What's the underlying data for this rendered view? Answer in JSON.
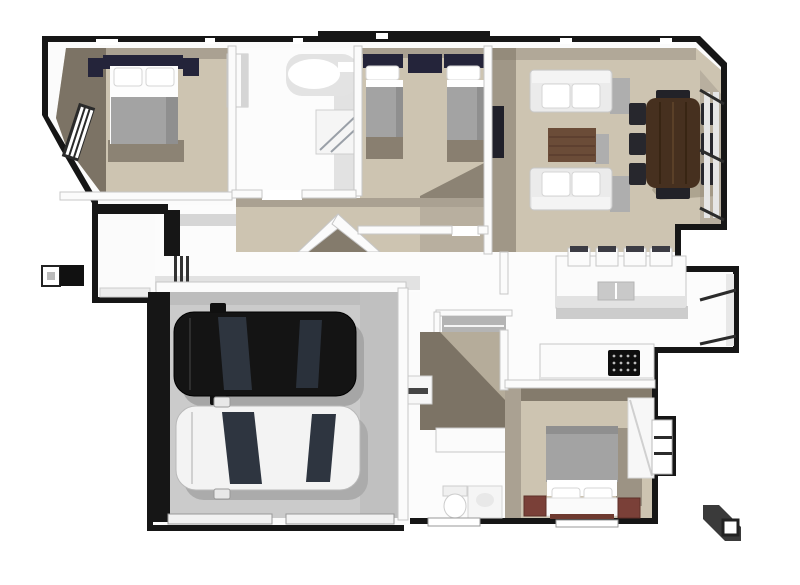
{
  "scene": {
    "type": "3d-floor-plan-render-top-view",
    "background": "#ffffff"
  },
  "colors": {
    "background": "#ffffff",
    "outline": "#161616",
    "wall": "#fbfbfb",
    "wall_edge": "#c7c7c7",
    "carpet": "#cdc4b1",
    "carpet_mid": "#aaa192",
    "carpet_shadow": "#7c7365",
    "floor_white": "#fcfcfc",
    "floor_shadow": "#e2e2e2",
    "garage_floor": "#cbcbcb",
    "garage_shadow": "#bdbdbd",
    "car_black": "#141414",
    "car_white": "#f3f3f3",
    "car_glass": "#333b46",
    "navy": "#24243a",
    "duvet": "#a3a3a3",
    "linen": "#ffffff",
    "sofa": "#ebebeb",
    "sofa_shadow": "#aeaeae",
    "wood_dark": "#46301f",
    "wood_mid": "#6b4c38",
    "chair": "#27272d",
    "timber_red": "#7a4038",
    "cooktop": "#0e0e0e",
    "steel": "#c9c9c9",
    "stair": "#b4b4b4",
    "shadow_gray": "#d6d6d6"
  },
  "rooms": [
    {
      "id": "master-bedroom",
      "area": "top-left",
      "floor": "carpet",
      "contents": [
        "double-bed-navy-headboard",
        "two-navy-nightstands",
        "side-window"
      ]
    },
    {
      "id": "bathroom",
      "area": "top-center",
      "floor": "white",
      "contents": [
        "freestanding-bathtub",
        "walk-in-shower",
        "tall-cabinet"
      ]
    },
    {
      "id": "second-bedroom",
      "area": "top-center-right",
      "floor": "carpet",
      "contents": [
        "twin-bed-left",
        "twin-bed-right",
        "shared-navy-nightstand"
      ]
    },
    {
      "id": "living-room",
      "area": "top-right",
      "floor": "carpet",
      "contents": [
        "sofa-upper",
        "sofa-lower",
        "timber-coffee-table",
        "dining-table",
        "eight-dark-chairs",
        "wall-tv"
      ]
    },
    {
      "id": "kitchen",
      "area": "center-right",
      "floor": "white",
      "contents": [
        "island-bench",
        "four-bar-stools",
        "double-sink",
        "black-cooktop",
        "bay-window-bench"
      ]
    },
    {
      "id": "entry-hall",
      "area": "center-left",
      "floor": "white",
      "contents": [
        "front-door-sidelights",
        "porch",
        "black-entry-wall"
      ]
    },
    {
      "id": "hallway",
      "area": "center",
      "floor": "carpet",
      "contents": [
        "angled-walls",
        "staircase"
      ]
    },
    {
      "id": "garage",
      "area": "bottom-left",
      "floor": "concrete",
      "contents": [
        "black-car",
        "white-car",
        "two-garage-door-openings"
      ]
    },
    {
      "id": "laundry-bathroom",
      "area": "bottom-center",
      "floor": "white",
      "contents": [
        "toilet",
        "vanity-basin",
        "washing-machine"
      ]
    },
    {
      "id": "third-bedroom",
      "area": "bottom-right",
      "floor": "carpet",
      "contents": [
        "double-bed-white-headboard",
        "two-timber-nightstands",
        "wardrobe",
        "window"
      ]
    }
  ],
  "vehicles": [
    {
      "id": "black-car",
      "color": "#141414",
      "facing": "left"
    },
    {
      "id": "white-car",
      "color": "#f3f3f3",
      "facing": "left"
    }
  ],
  "exterior_objects": [
    {
      "id": "letterbox",
      "position": "left-edge"
    },
    {
      "id": "chimney-block",
      "position": "bottom-right"
    }
  ]
}
